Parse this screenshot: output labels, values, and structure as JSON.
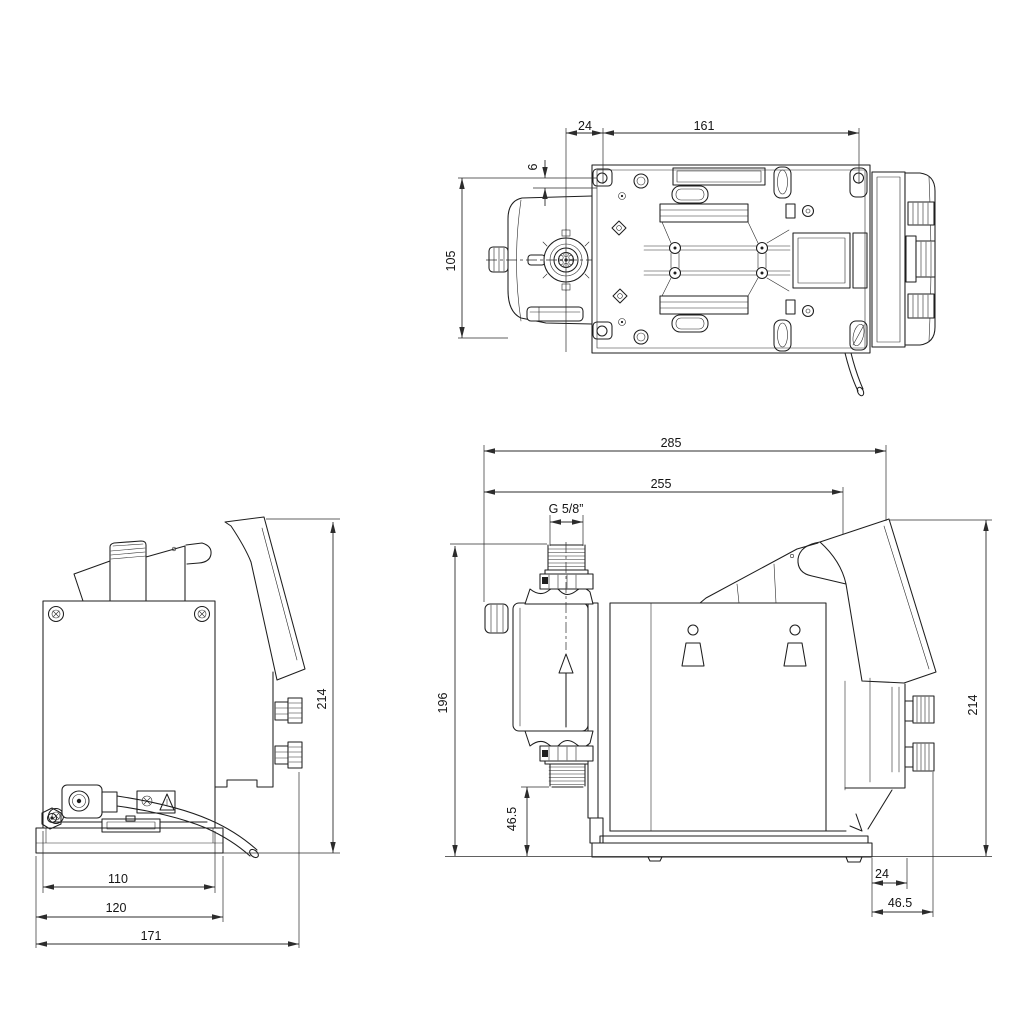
{
  "meta": {
    "ink_color": "#1e1e1e",
    "background": "#ffffff",
    "drawing_type": "pump dimensional drawing, three orthographic views"
  },
  "views": {
    "top": {
      "dims": {
        "d24": "24",
        "d161": "161",
        "d6": "6",
        "d105": "105"
      }
    },
    "front": {
      "dims": {
        "d214": "214",
        "d110": "110",
        "d120": "120",
        "d171": "171"
      }
    },
    "side": {
      "dims": {
        "d285": "285",
        "d255": "255",
        "thread": "G 5/8”",
        "d196": "196",
        "d46_5_side": "46.5",
        "d214": "214",
        "d24": "24",
        "d46_5_bottom": "46.5"
      }
    }
  }
}
